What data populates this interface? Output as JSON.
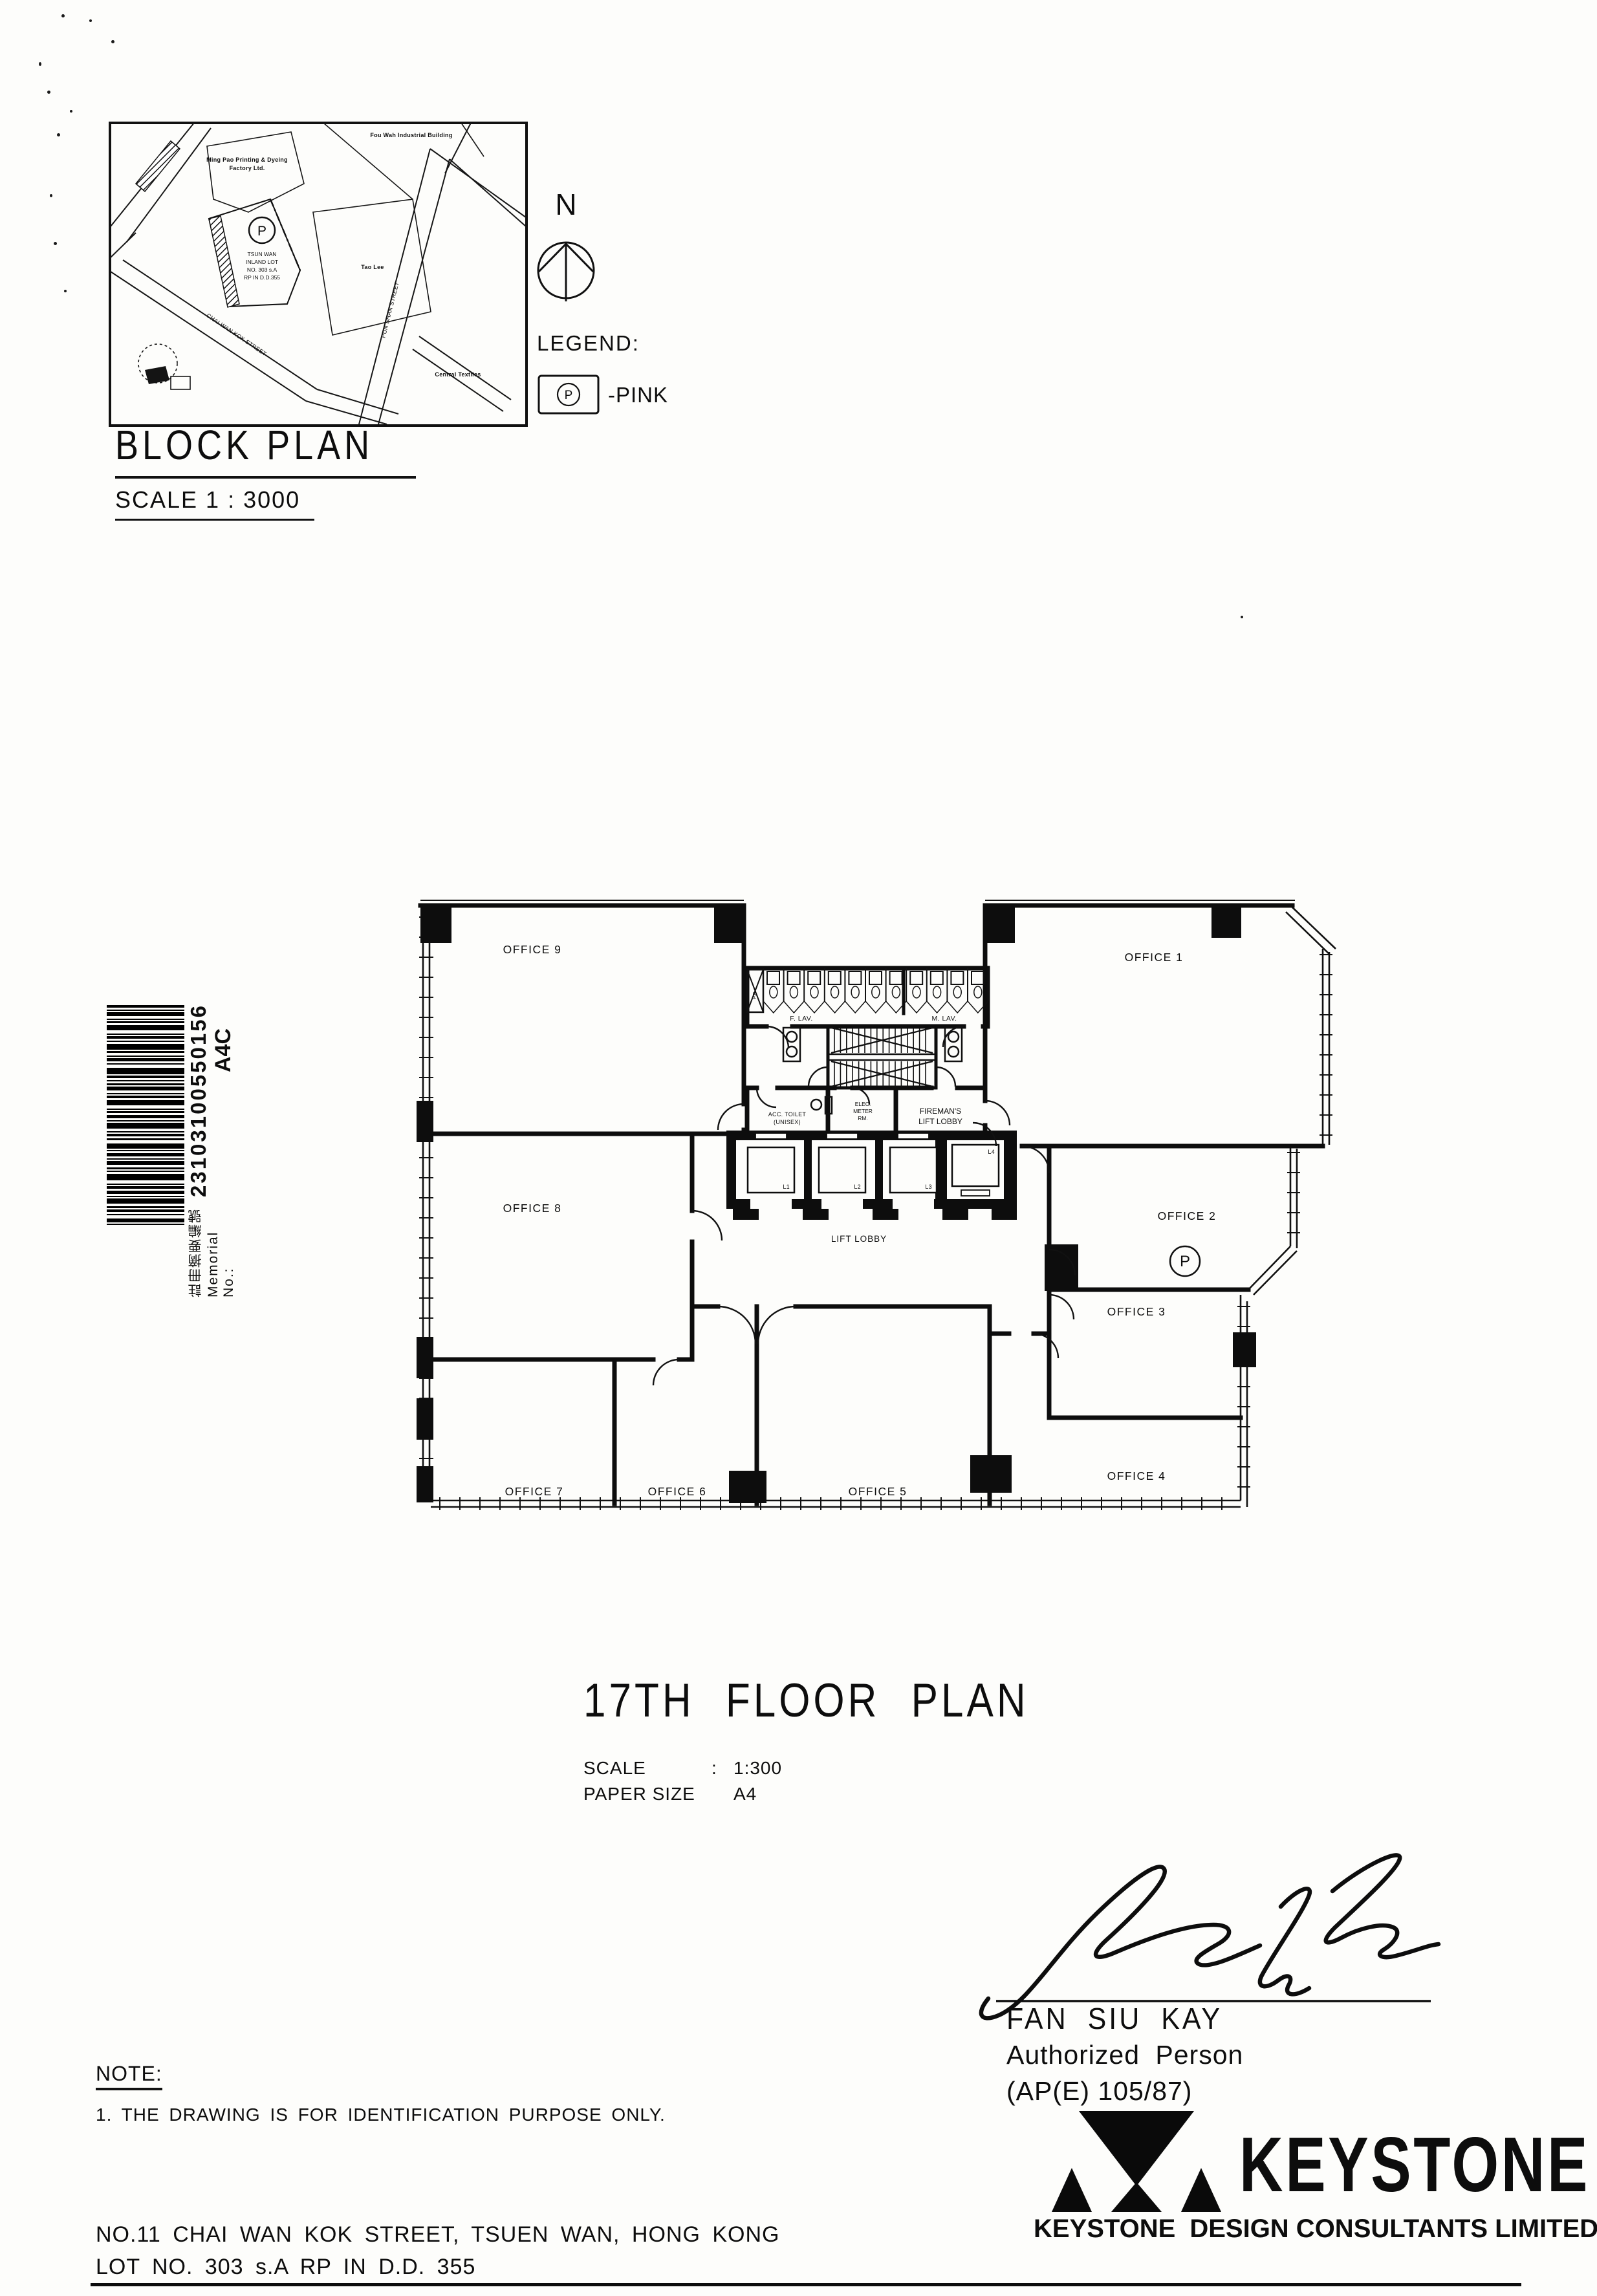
{
  "block_plan": {
    "title": "BLOCK PLAN",
    "scale": "SCALE 1 : 3000",
    "p_marker": "P",
    "site_lines": [
      "TSUN WAN",
      "INLAND LOT",
      "NO. 303 s.A",
      "RP IN D.D.355"
    ],
    "labels": {
      "fou_wah": "Fou Wah Industrial Building",
      "ming_pao_1": "Ming Pao Printing & Dyeing",
      "ming_pao_2": "Factory Ltd.",
      "tao_lee": "Tao Lee",
      "pun_shan": "PUN SHAN STREET",
      "chai_wan_kok": "CHAI WAN KOK STREET",
      "central": "Central Textiles"
    }
  },
  "north": {
    "label": "N"
  },
  "legend": {
    "title": "LEGEND:",
    "p": "P",
    "value": "-PINK"
  },
  "memorial": {
    "label": "註冊摘要編號  Memorial No.:",
    "number": "23103100550156",
    "code": "A4C"
  },
  "floor_plan": {
    "offices": {
      "o1": "OFFICE 1",
      "o2": "OFFICE 2",
      "o3": "OFFICE 3",
      "o4": "OFFICE 4",
      "o5": "OFFICE 5",
      "o6": "OFFICE 6",
      "o7": "OFFICE 7",
      "o8": "OFFICE 8",
      "o9": "OFFICE 9"
    },
    "f_lav": "F. LAV.",
    "m_lav": "M. LAV.",
    "pd": "P.D.",
    "acc_1": "ACC. TOILET",
    "acc_2": "(UNISEX)",
    "elec_1": "ELEC.",
    "elec_2": "METER",
    "elec_3": "RM.",
    "fireman_1": "FIREMAN'S",
    "fireman_2": "LIFT LOBBY",
    "lift_lobby": "LIFT LOBBY",
    "lifts": {
      "l1": "L1",
      "l2": "L2",
      "l3": "L3",
      "l4": "L4"
    },
    "p_marker": "P"
  },
  "title_block": {
    "title": "17TH FLOOR PLAN",
    "scale_label": "SCALE",
    "scale_colon": ":",
    "scale_value": "1:300",
    "paper_label": "PAPER SIZE",
    "paper_colon": "",
    "paper_value": "A4"
  },
  "signature": {
    "name": "FAN SIU KAY",
    "role": "Authorized Person",
    "cert": "(AP(E) 105/87)"
  },
  "brand": {
    "logo_text": "KEYSTONE",
    "name_small": "KEYSTONE",
    "suffix": "DESIGN CONSULTANTS LIMITED"
  },
  "note": {
    "heading": "NOTE:",
    "item": "1. THE DRAWING IS FOR IDENTIFICATION PURPOSE ONLY."
  },
  "address": {
    "line1": "NO.11 CHAI WAN KOK STREET, TSUEN WAN, HONG KONG",
    "line2": "LOT NO. 303 s.A RP IN D.D. 355"
  }
}
